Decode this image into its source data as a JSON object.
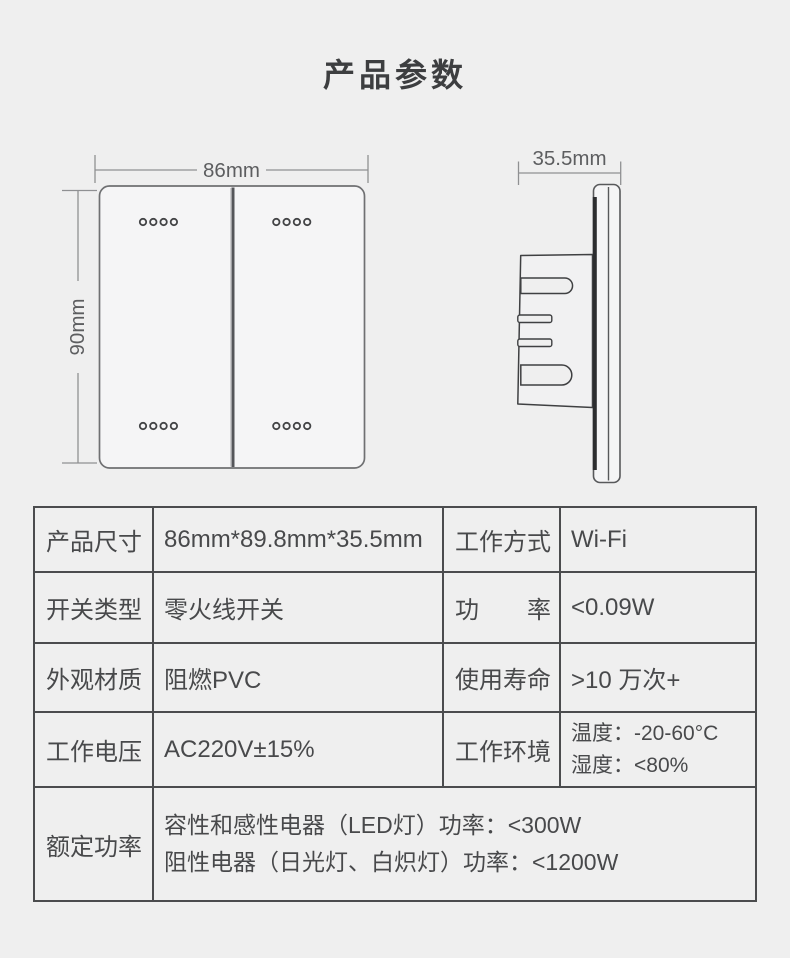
{
  "page": {
    "title": "产品参数",
    "background": "#efefef"
  },
  "colors": {
    "title_text": "#3d3e40",
    "table_border": "#4b4c4e",
    "table_text": "#48494b",
    "drawing_stroke": "#3f4042",
    "panel_fill": "#f5f5f6",
    "dimension_line": "#8f9092",
    "dimension_text": "#5d5e60"
  },
  "front_view": {
    "width_label": "86mm",
    "height_label": "90mm"
  },
  "side_view": {
    "depth_label": "35.5mm"
  },
  "spec_table": {
    "rows": [
      {
        "k1": "产品尺寸",
        "v1": "86mm*89.8mm*35.5mm",
        "k2": "工作方式",
        "v2": "Wi-Fi"
      },
      {
        "k1": "开关类型",
        "v1": "零火线开关",
        "k2": "功　　率",
        "v2": "<0.09W"
      },
      {
        "k1": "外观材质",
        "v1": "阻燃PVC",
        "k2": "使用寿命",
        "v2": ">10 万次+"
      },
      {
        "k1": "工作电压",
        "v1": "AC220V±15%",
        "k2": "工作环境",
        "v2_line1": "温度：-20-60°C",
        "v2_line2": "湿度：<80%"
      },
      {
        "k1": "额定功率",
        "v_line1": "容性和感性电器（LED灯）功率：<300W",
        "v_line2": "阻性电器（日光灯、白炽灯）功率：<1200W"
      }
    ]
  }
}
